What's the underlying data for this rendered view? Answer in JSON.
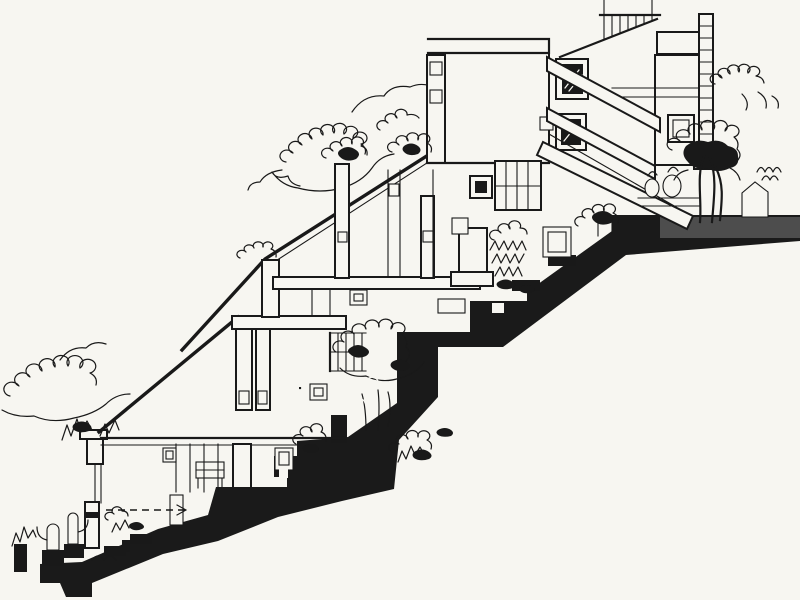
{
  "meta": {
    "domain": "architectural-drawing",
    "title": "Hillside terraced housing — cross section",
    "description": "Black-ink architectural section of stepped houses descending a hillside: an upper multi-storey block with external stair flights and a hatched top stair, two lower terrace units with long sloping mono-pitch roofs, a thick stepped black ground/retaining mass running from upper right to lower left, and freehand vegetation (tree clouds, shrubs, cacti in pots) plus a small dashed annotation arrow."
  },
  "drawing": {
    "colors": {
      "paper": "#f7f6f1",
      "ink": "#191919",
      "ground_fill": "#1a1a1a",
      "ground_gray": "#4d4d4d"
    },
    "elements": [
      "stepped-ground-mass",
      "upper-building",
      "top-stair-flight",
      "stair-landing",
      "ladder-column",
      "right-wing-window",
      "dark-windows",
      "stair-flights",
      "middle-terrace-house",
      "sloped-roof",
      "chimney-mast",
      "mullioned-window",
      "lower-terrace-house",
      "hanging-columns",
      "interior-studs",
      "terrace-railing",
      "right-tree",
      "foliage-clouds",
      "cacti-planters",
      "annotation-arrow"
    ]
  }
}
